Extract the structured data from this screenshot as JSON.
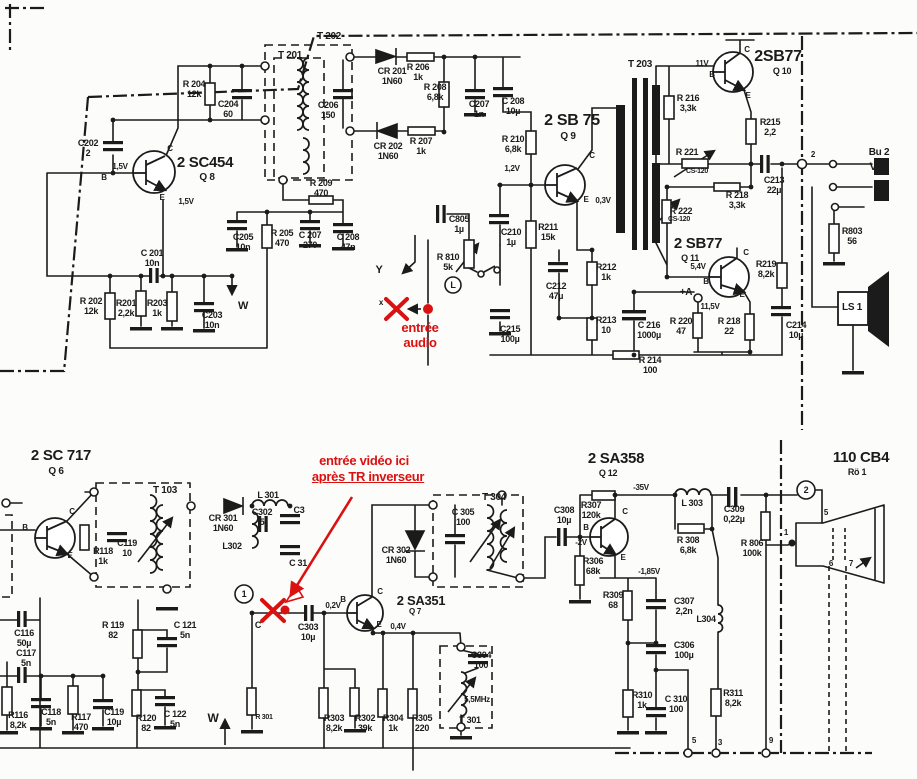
{
  "schematic": {
    "description": "Scanned TV receiver schematic: audio output stage (2SC454, 2SB75, 2SB77 x2, transformers T201-T203, speaker LS1, jack Bu2) and video/sound IF stage (2SC717, 2SA351, 2SA358, T103, T301 5,5MHz, T304, picture tube 110CB4), with red French annotations marking audio and video injection points",
    "annotation_color": "#d91111",
    "ink_color": "#1b1b1b",
    "labels": [
      {
        "n": "t202-label",
        "t": "T 202",
        "x": 329,
        "y": 31,
        "s": 10
      },
      {
        "n": "t201-label",
        "t": "T 201",
        "x": 290,
        "y": 50,
        "s": 10
      },
      {
        "n": "q8-type-label",
        "t": "2 SC454",
        "x": 205,
        "y": 155,
        "s": 15
      },
      {
        "n": "q8-ref-label",
        "t": "Q 8",
        "x": 207,
        "y": 172,
        "s": 10
      },
      {
        "n": "q8-base-volt-label",
        "t": "1,5V",
        "x": 120,
        "y": 163,
        "s": 8
      },
      {
        "n": "q8-b-label",
        "t": "B",
        "x": 104,
        "y": 174,
        "s": 8
      },
      {
        "n": "q8-c-label",
        "t": "C",
        "x": 170,
        "y": 145,
        "s": 8
      },
      {
        "n": "q8-e-label",
        "t": "E",
        "x": 162,
        "y": 194,
        "s": 8
      },
      {
        "n": "q8-emitter-volt-label",
        "t": "1,5V",
        "x": 186,
        "y": 198,
        "s": 8
      },
      {
        "n": "c202-label",
        "t": "C202\n2",
        "x": 88,
        "y": 138
      },
      {
        "n": "r204-label",
        "t": "R 204\n12k",
        "x": 194,
        "y": 79
      },
      {
        "n": "c204-label",
        "t": "C204\n60",
        "x": 228,
        "y": 99
      },
      {
        "n": "c201-label",
        "t": "C 201\n10n",
        "x": 152,
        "y": 248
      },
      {
        "n": "r202-label",
        "t": "R 202\n12k",
        "x": 91,
        "y": 296
      },
      {
        "n": "r201-label",
        "t": "R201\n2,2k",
        "x": 126,
        "y": 298
      },
      {
        "n": "r203-label",
        "t": "R203\n1k",
        "x": 157,
        "y": 298
      },
      {
        "n": "c203-label",
        "t": "C203\n10n",
        "x": 212,
        "y": 310
      },
      {
        "n": "w-down-label",
        "t": "W",
        "x": 243,
        "y": 300,
        "s": 11
      },
      {
        "n": "c205-label",
        "t": "C205\n10n",
        "x": 243,
        "y": 232
      },
      {
        "n": "r205-label",
        "t": "R 205\n470",
        "x": 282,
        "y": 228
      },
      {
        "n": "c207b-label",
        "t": "C 207\n270",
        "x": 310,
        "y": 230
      },
      {
        "n": "c208b-label",
        "t": "C 208\n47n",
        "x": 348,
        "y": 232
      },
      {
        "n": "r209-label",
        "t": "R 209\n470",
        "x": 321,
        "y": 178
      },
      {
        "n": "c206-label",
        "t": "C206\n150",
        "x": 328,
        "y": 100
      },
      {
        "n": "cr201-label",
        "t": "CR 201\n1N60",
        "x": 392,
        "y": 66
      },
      {
        "n": "r206-label",
        "t": "R 206\n1k",
        "x": 418,
        "y": 62
      },
      {
        "n": "r208-label",
        "t": "R 208\n6,8k",
        "x": 435,
        "y": 82
      },
      {
        "n": "c207a-label",
        "t": "C207\n1n",
        "x": 479,
        "y": 99
      },
      {
        "n": "c208a-label",
        "t": "C 208\n10µ",
        "x": 513,
        "y": 96
      },
      {
        "n": "cr202-label",
        "t": "CR 202\n1N60",
        "x": 388,
        "y": 141
      },
      {
        "n": "r207-label",
        "t": "R 207\n1k",
        "x": 421,
        "y": 136
      },
      {
        "n": "q9-type-label",
        "t": "2 SB 75",
        "x": 572,
        "y": 112,
        "s": 16
      },
      {
        "n": "q9-ref-label",
        "t": "Q 9",
        "x": 568,
        "y": 131,
        "s": 10
      },
      {
        "n": "r210-label",
        "t": "R 210\n6,8k",
        "x": 513,
        "y": 134
      },
      {
        "n": "q9-base-volt-label",
        "t": "1,2V",
        "x": 512,
        "y": 165,
        "s": 8
      },
      {
        "n": "q9-c-label",
        "t": "C",
        "x": 592,
        "y": 152,
        "s": 8
      },
      {
        "n": "q9-e-label",
        "t": "E",
        "x": 586,
        "y": 196,
        "s": 8
      },
      {
        "n": "q9-emitter-volt-label",
        "t": "0,3V",
        "x": 603,
        "y": 197,
        "s": 8
      },
      {
        "n": "c805-label",
        "t": "C805\n1µ",
        "x": 459,
        "y": 214
      },
      {
        "n": "r810-label",
        "t": "R 810\n5k",
        "x": 448,
        "y": 252
      },
      {
        "n": "volume-control-label",
        "t": "L",
        "x": 453,
        "y": 280,
        "s": 9
      },
      {
        "n": "c210-label",
        "t": "C210\n1µ",
        "x": 511,
        "y": 227
      },
      {
        "n": "r211-label",
        "t": "R211\n15k",
        "x": 548,
        "y": 222
      },
      {
        "n": "c215-label",
        "t": "C215\n100µ",
        "x": 510,
        "y": 324
      },
      {
        "n": "r212-label",
        "t": "R212\n1k",
        "x": 606,
        "y": 262
      },
      {
        "n": "c212-label",
        "t": "C212\n47µ",
        "x": 556,
        "y": 281
      },
      {
        "n": "r213-label",
        "t": "R213\n10",
        "x": 606,
        "y": 315
      },
      {
        "n": "c216-label",
        "t": "C 216\n1000µ",
        "x": 649,
        "y": 320
      },
      {
        "n": "r214-label",
        "t": "R 214\n100",
        "x": 650,
        "y": 355
      },
      {
        "n": "t203-label",
        "t": "T 203",
        "x": 640,
        "y": 59,
        "s": 10
      },
      {
        "n": "q10-type-label",
        "t": "2SB77",
        "x": 778,
        "y": 48,
        "s": 16
      },
      {
        "n": "q10-ref-label",
        "t": "Q 10",
        "x": 782,
        "y": 66,
        "s": 9
      },
      {
        "n": "q10-base-volt-label",
        "t": "11V",
        "x": 702,
        "y": 60,
        "s": 8
      },
      {
        "n": "q10-b-label",
        "t": "B",
        "x": 712,
        "y": 71,
        "s": 8
      },
      {
        "n": "q10-c-label",
        "t": "C",
        "x": 747,
        "y": 46,
        "s": 8
      },
      {
        "n": "q10-e-label",
        "t": "E",
        "x": 748,
        "y": 92,
        "s": 8
      },
      {
        "n": "r216-label",
        "t": "R 216\n3,3k",
        "x": 688,
        "y": 93
      },
      {
        "n": "r215-label",
        "t": "R215\n2,2",
        "x": 770,
        "y": 117
      },
      {
        "n": "r221-label",
        "t": "R 221",
        "x": 687,
        "y": 147,
        "s": 9
      },
      {
        "n": "r221-value-label",
        "t": "CS-120",
        "x": 697,
        "y": 168,
        "s": 7
      },
      {
        "n": "r218a-label",
        "t": "R 218\n3,3k",
        "x": 737,
        "y": 190
      },
      {
        "n": "c213-label",
        "t": "C213\n22µ",
        "x": 774,
        "y": 175
      },
      {
        "n": "bu2-label",
        "t": "Bu 2",
        "x": 879,
        "y": 147,
        "s": 10
      },
      {
        "n": "bu2-v-label",
        "t": "V",
        "x": 873,
        "y": 161,
        "s": 11
      },
      {
        "n": "node2-top-label",
        "t": "2",
        "x": 813,
        "y": 151,
        "s": 8
      },
      {
        "n": "r222-label",
        "t": "R 222",
        "x": 681,
        "y": 206,
        "s": 9
      },
      {
        "n": "r222-value-label",
        "t": "CS-120",
        "x": 679,
        "y": 216,
        "s": 7
      },
      {
        "n": "q11-type-label",
        "t": "2 SB77",
        "x": 698,
        "y": 236,
        "s": 15
      },
      {
        "n": "q11-ref-label",
        "t": "Q 11",
        "x": 690,
        "y": 253,
        "s": 9
      },
      {
        "n": "q11-base-volt-label",
        "t": "5,4V",
        "x": 698,
        "y": 263,
        "s": 8
      },
      {
        "n": "q11-b-label",
        "t": "B",
        "x": 706,
        "y": 278,
        "s": 8
      },
      {
        "n": "q11-c-label",
        "t": "C",
        "x": 746,
        "y": 249,
        "s": 8
      },
      {
        "n": "q11-e-label",
        "t": "E",
        "x": 742,
        "y": 291,
        "s": 8
      },
      {
        "n": "r219-label",
        "t": "R219\n8,2k",
        "x": 766,
        "y": 259
      },
      {
        "n": "plus-a-label",
        "t": "+A",
        "x": 686,
        "y": 287,
        "s": 10
      },
      {
        "n": "a-volt-label",
        "t": "11,5V",
        "x": 710,
        "y": 303,
        "s": 8
      },
      {
        "n": "r220-label",
        "t": "R 220\n47",
        "x": 681,
        "y": 316
      },
      {
        "n": "r218b-label",
        "t": "R 218\n22",
        "x": 729,
        "y": 316
      },
      {
        "n": "c214-label",
        "t": "C214\n10µ",
        "x": 796,
        "y": 320
      },
      {
        "n": "r803-label",
        "t": "R803\n56",
        "x": 852,
        "y": 226
      },
      {
        "n": "ls1-label",
        "t": "LS 1",
        "x": 852,
        "y": 302,
        "s": 10
      },
      {
        "n": "y-arrow-label",
        "t": "Y",
        "x": 379,
        "y": 264,
        "s": 11
      },
      {
        "n": "x-mark-label",
        "t": "x",
        "x": 381,
        "y": 299,
        "s": 8
      },
      {
        "n": "audio-entry-annotation",
        "t": "entrée\naudio",
        "x": 420,
        "y": 321,
        "s": 13,
        "c": 1
      },
      {
        "n": "q6-type-label",
        "t": "2 SC 717",
        "x": 61,
        "y": 448,
        "s": 15
      },
      {
        "n": "q6-ref-label",
        "t": "Q 6",
        "x": 56,
        "y": 466,
        "s": 10
      },
      {
        "n": "t103-label",
        "t": "T 103",
        "x": 165,
        "y": 485,
        "s": 10
      },
      {
        "n": "q6-b-label",
        "t": "B",
        "x": 25,
        "y": 524,
        "s": 8
      },
      {
        "n": "q6-c-label",
        "t": "C",
        "x": 72,
        "y": 508,
        "s": 8
      },
      {
        "n": "q6-e-label",
        "t": "E",
        "x": 70,
        "y": 552,
        "s": 8
      },
      {
        "n": "r118-label",
        "t": "R118\n1k",
        "x": 103,
        "y": 546
      },
      {
        "n": "c119a-label",
        "t": "C119\n10",
        "x": 127,
        "y": 538
      },
      {
        "n": "cr301-label",
        "t": "CR 301\n1N60",
        "x": 223,
        "y": 513
      },
      {
        "n": "l302-label",
        "t": "L302",
        "x": 232,
        "y": 541,
        "s": 9
      },
      {
        "n": "l301-label",
        "t": "L 301",
        "x": 268,
        "y": 490,
        "s": 9
      },
      {
        "n": "c302-label",
        "t": "C302\n5",
        "x": 262,
        "y": 507
      },
      {
        "n": "c3-label",
        "t": "C3",
        "x": 299,
        "y": 505,
        "s": 9
      },
      {
        "n": "c31-label",
        "t": "C 31",
        "x": 298,
        "y": 558,
        "s": 9
      },
      {
        "n": "video-entry-annotation-line1",
        "t": "entrée vidéo ici",
        "x": 364,
        "y": 454,
        "s": 13,
        "c": 1
      },
      {
        "n": "video-entry-annotation-line2",
        "t": "après TR inverseur",
        "x": 368,
        "y": 470,
        "s": 13,
        "c": 1,
        "u": 1
      },
      {
        "n": "q7-base-c-label",
        "t": "C",
        "x": 258,
        "y": 620,
        "s": 9
      },
      {
        "n": "c303-label",
        "t": "C303\n10µ",
        "x": 308,
        "y": 622
      },
      {
        "n": "q7-base-volt-label",
        "t": "0,2V",
        "x": 333,
        "y": 602,
        "s": 8
      },
      {
        "n": "q7-b-label",
        "t": "B",
        "x": 343,
        "y": 596,
        "s": 8
      },
      {
        "n": "q7-type-label",
        "t": "2 SA351",
        "x": 421,
        "y": 594,
        "s": 13
      },
      {
        "n": "q7-ref-label",
        "t": "Q 7",
        "x": 415,
        "y": 608,
        "s": 8
      },
      {
        "n": "q7-c-label",
        "t": "C",
        "x": 380,
        "y": 588,
        "s": 8
      },
      {
        "n": "q7-e-label",
        "t": "E",
        "x": 379,
        "y": 621,
        "s": 8
      },
      {
        "n": "q7-emitter-volt-label",
        "t": "0,4V",
        "x": 398,
        "y": 623,
        "s": 8
      },
      {
        "n": "cr302-label",
        "t": "CR 302\n1N60",
        "x": 396,
        "y": 545
      },
      {
        "n": "c305-label",
        "t": "C 305\n100",
        "x": 463,
        "y": 507
      },
      {
        "n": "t304-label",
        "t": "T 304",
        "x": 494,
        "y": 492,
        "s": 10
      },
      {
        "n": "r301-label",
        "t": "R 301",
        "x": 264,
        "y": 714,
        "s": 7
      },
      {
        "n": "w-up-label",
        "t": "W",
        "x": 213,
        "y": 712,
        "s": 12
      },
      {
        "n": "r303-label",
        "t": "R303\n8,2k",
        "x": 334,
        "y": 713
      },
      {
        "n": "r302-label",
        "t": "R302\n39k",
        "x": 365,
        "y": 713
      },
      {
        "n": "r304-label",
        "t": "R304\n1k",
        "x": 393,
        "y": 713
      },
      {
        "n": "r305-label",
        "t": "R305\n220",
        "x": 422,
        "y": 713
      },
      {
        "n": "c304-label",
        "t": "C304\n100",
        "x": 481,
        "y": 650
      },
      {
        "n": "trap-freq-label",
        "t": "5,5MHz",
        "x": 477,
        "y": 696,
        "s": 8
      },
      {
        "n": "t301-label",
        "t": "T 301",
        "x": 470,
        "y": 715,
        "s": 9
      },
      {
        "n": "q12-type-label",
        "t": "2 SA358",
        "x": 616,
        "y": 451,
        "s": 15
      },
      {
        "n": "q12-ref-label",
        "t": "Q 12",
        "x": 608,
        "y": 468,
        "s": 9
      },
      {
        "n": "q12-coll-volt-label",
        "t": "-35V",
        "x": 641,
        "y": 484,
        "s": 8
      },
      {
        "n": "r307-label",
        "t": "R307\n120k",
        "x": 591,
        "y": 500
      },
      {
        "n": "c308-label",
        "t": "C308\n10µ",
        "x": 564,
        "y": 505
      },
      {
        "n": "q12-b-label",
        "t": "B",
        "x": 586,
        "y": 524,
        "s": 8
      },
      {
        "n": "q12-c-label",
        "t": "C",
        "x": 625,
        "y": 508,
        "s": 8
      },
      {
        "n": "q12-e-label",
        "t": "E",
        "x": 623,
        "y": 554,
        "s": 8
      },
      {
        "n": "q12-base-volt-label",
        "t": "-2V",
        "x": 581,
        "y": 539,
        "s": 8
      },
      {
        "n": "r306-label",
        "t": "R306\n68k",
        "x": 593,
        "y": 556
      },
      {
        "n": "l303-label",
        "t": "L 303",
        "x": 692,
        "y": 498,
        "s": 9
      },
      {
        "n": "r308-label",
        "t": "R 308\n6,8k",
        "x": 688,
        "y": 535
      },
      {
        "n": "c309-label",
        "t": "C309\n0,22µ",
        "x": 734,
        "y": 504
      },
      {
        "n": "r806-label",
        "t": "R 806\n100k",
        "x": 752,
        "y": 538
      },
      {
        "n": "q12-emitter-volt-label",
        "t": "-1,85V",
        "x": 649,
        "y": 568,
        "s": 8
      },
      {
        "n": "r309-label",
        "t": "R309\n68",
        "x": 613,
        "y": 590
      },
      {
        "n": "c307-label",
        "t": "C307\n2,2n",
        "x": 684,
        "y": 596
      },
      {
        "n": "l304-label",
        "t": "L304",
        "x": 706,
        "y": 614,
        "s": 9
      },
      {
        "n": "c306-label",
        "t": "C306\n100µ",
        "x": 684,
        "y": 640
      },
      {
        "n": "r310-label",
        "t": "R310\n1k",
        "x": 642,
        "y": 690
      },
      {
        "n": "c310-label",
        "t": "C 310\n100",
        "x": 676,
        "y": 694
      },
      {
        "n": "r311-label",
        "t": "R311\n8,2k",
        "x": 733,
        "y": 688
      },
      {
        "n": "pin5-bottom-label",
        "t": "5",
        "x": 694,
        "y": 737,
        "s": 8
      },
      {
        "n": "pin3-bottom-label",
        "t": "3",
        "x": 720,
        "y": 739,
        "s": 8
      },
      {
        "n": "pin9-bottom-label",
        "t": "9",
        "x": 771,
        "y": 737,
        "s": 8
      },
      {
        "n": "crt-type-label",
        "t": "110 CB4",
        "x": 861,
        "y": 450,
        "s": 15
      },
      {
        "n": "crt-ref-label",
        "t": "Rö 1",
        "x": 857,
        "y": 467,
        "s": 9
      },
      {
        "n": "node1-circle-label",
        "t": "1",
        "x": 244,
        "y": 589,
        "s": 9
      },
      {
        "n": "node2-circle-label",
        "t": "2",
        "x": 806,
        "y": 485,
        "s": 9
      },
      {
        "n": "crt-pin5-label",
        "t": "5",
        "x": 826,
        "y": 509,
        "s": 8
      },
      {
        "n": "crt-pin1-label",
        "t": "1",
        "x": 786,
        "y": 529,
        "s": 8
      },
      {
        "n": "crt-pin6-label",
        "t": "6",
        "x": 831,
        "y": 560,
        "s": 8
      },
      {
        "n": "crt-pin7-label",
        "t": "7",
        "x": 851,
        "y": 560,
        "s": 8
      },
      {
        "n": "r116-label",
        "t": "R116\n8,2k",
        "x": 18,
        "y": 710
      },
      {
        "n": "c116-label",
        "t": "C116\n50µ",
        "x": 24,
        "y": 628
      },
      {
        "n": "c117-label",
        "t": "C117\n5n",
        "x": 26,
        "y": 648
      },
      {
        "n": "c118-label",
        "t": "C118\n5n",
        "x": 51,
        "y": 707
      },
      {
        "n": "r117-label",
        "t": "R117\n470",
        "x": 81,
        "y": 712
      },
      {
        "n": "c119b-label",
        "t": "C119\n10µ",
        "x": 114,
        "y": 707
      },
      {
        "n": "r119-label",
        "t": "R 119\n82",
        "x": 113,
        "y": 620
      },
      {
        "n": "c121-label",
        "t": "C 121\n5n",
        "x": 185,
        "y": 620
      },
      {
        "n": "r120-label",
        "t": "R120\n82",
        "x": 146,
        "y": 713
      },
      {
        "n": "c122-label",
        "t": "C 122\n5n",
        "x": 175,
        "y": 709
      }
    ]
  }
}
